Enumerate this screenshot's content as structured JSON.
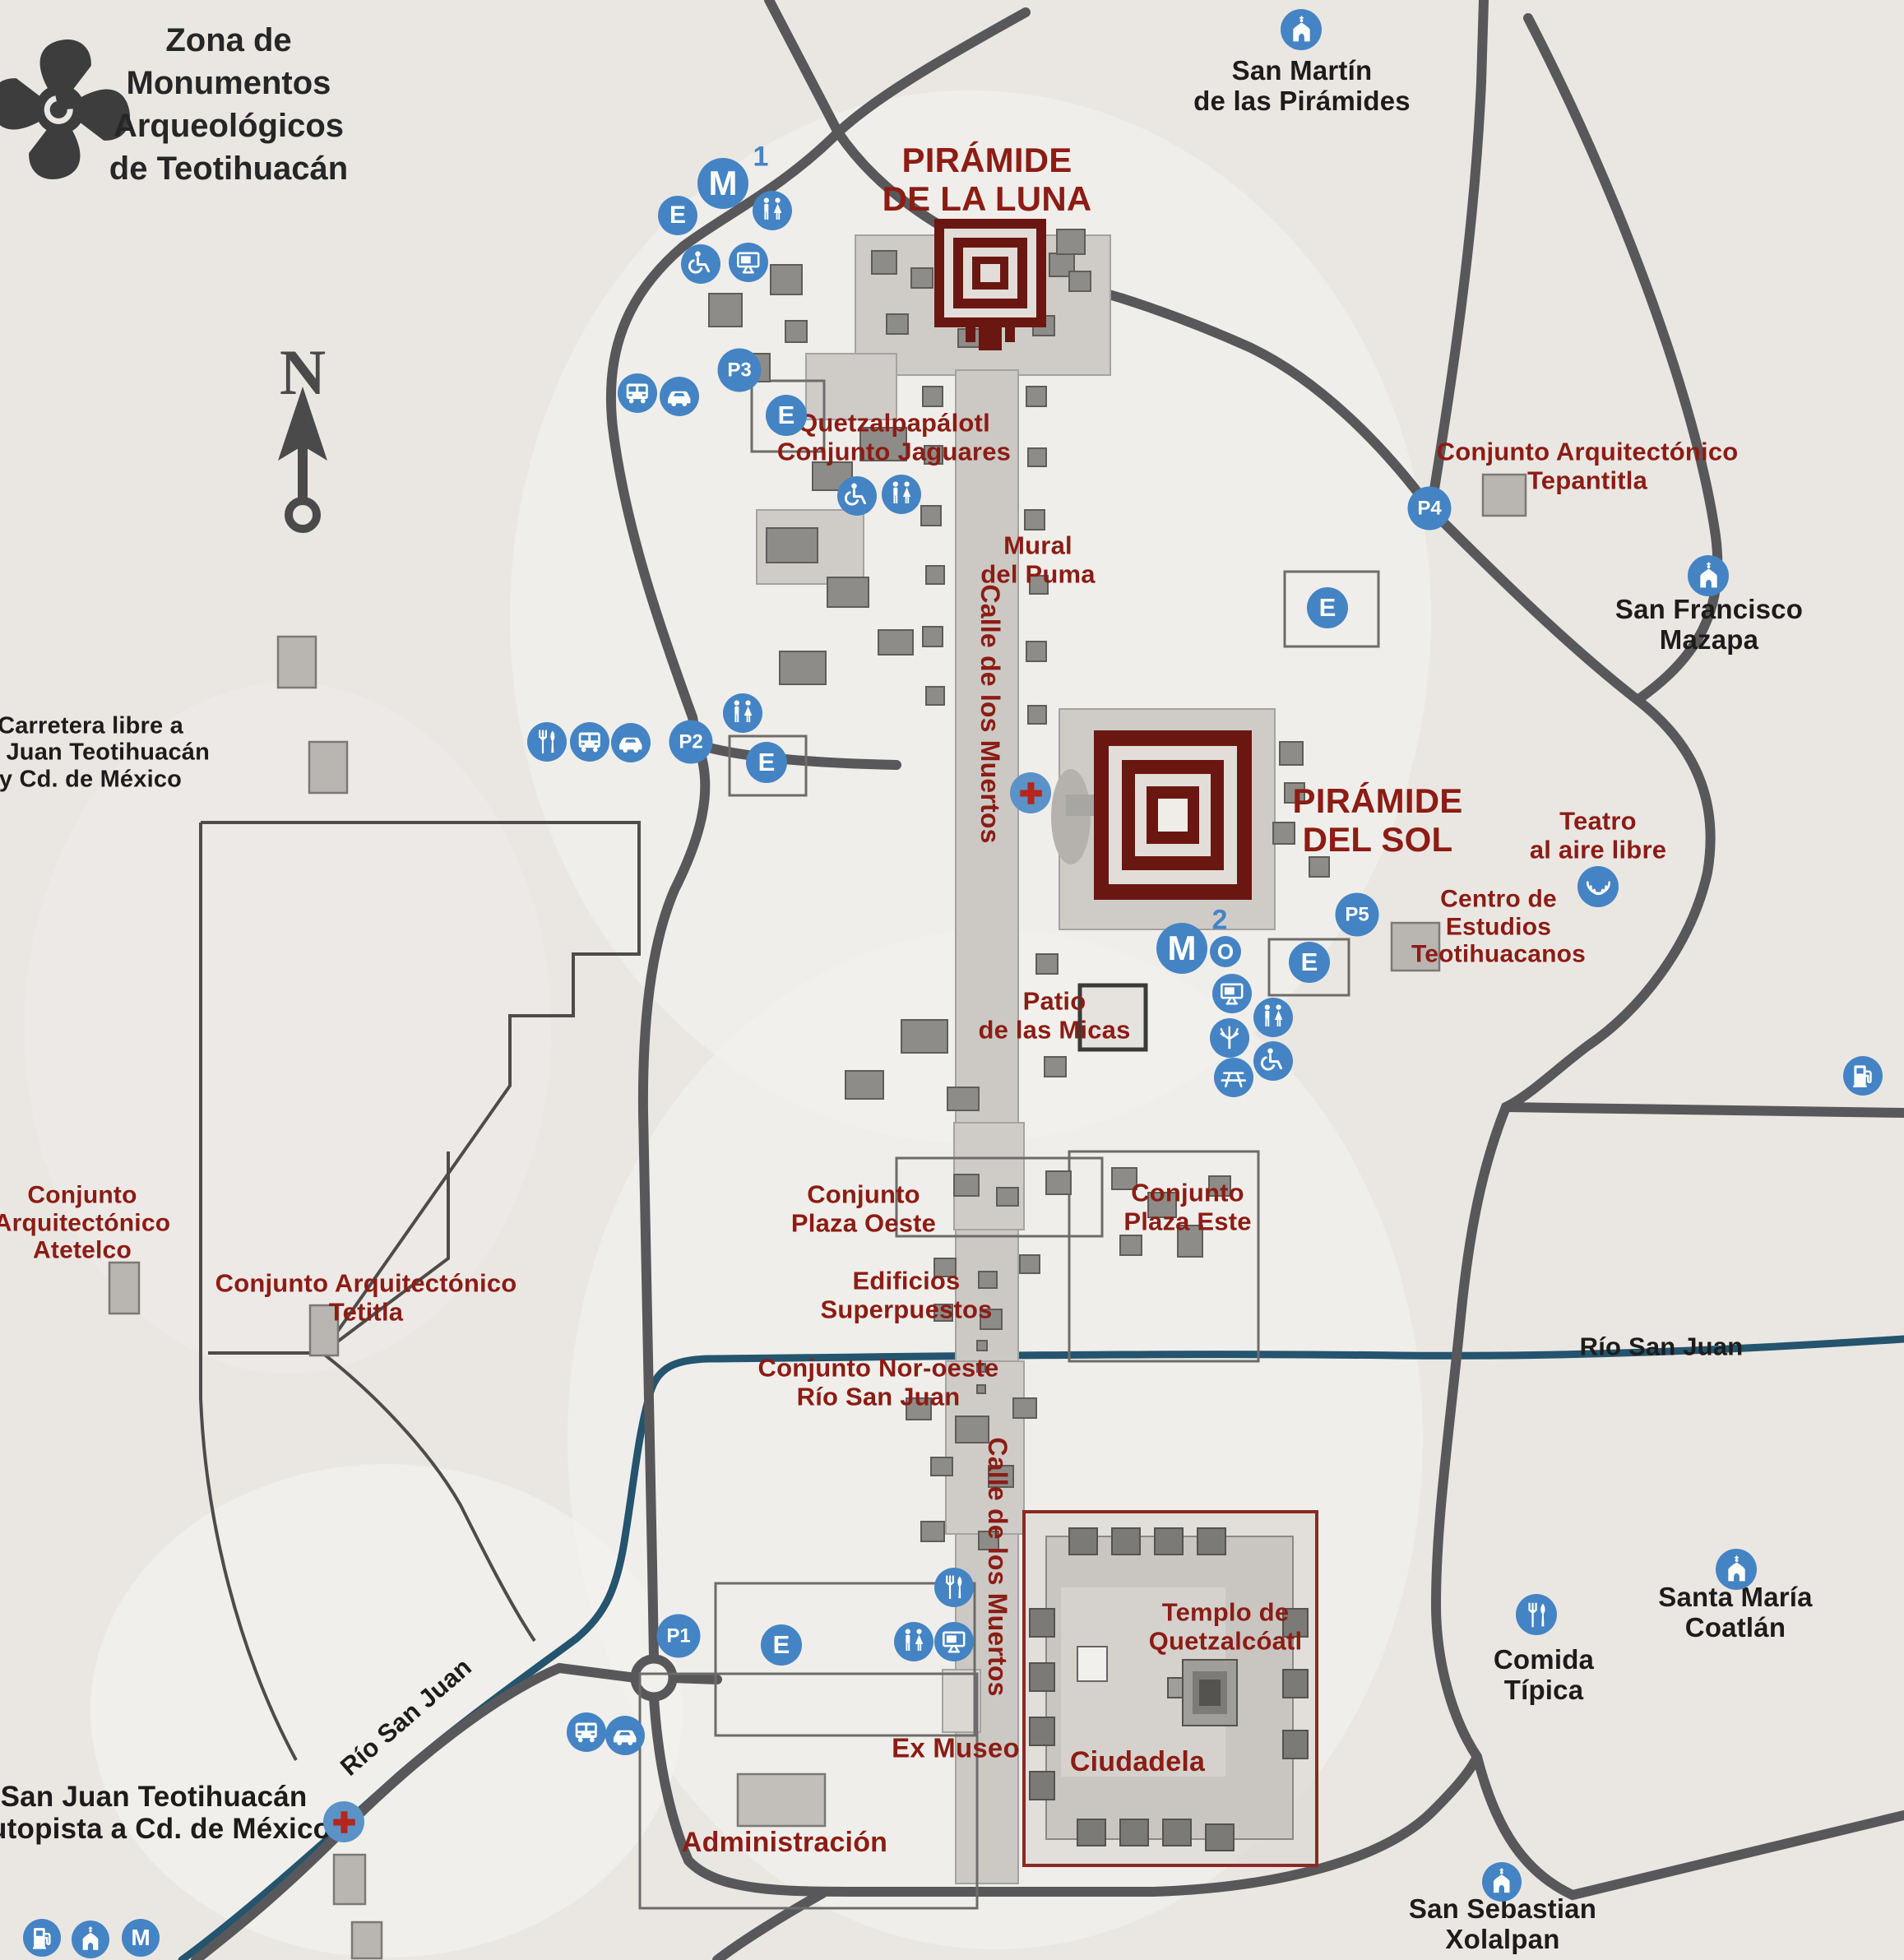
{
  "header": {
    "logo": "teotihuacan-glyph",
    "title": "Zona de\nMonumentos\nArqueológicos\nde Teotihuacán"
  },
  "compass": {
    "north": "N"
  },
  "colors": {
    "pin_blue": "#4484c4",
    "label_red": "#8c1c14",
    "pyramid_maroon": "#6b1711",
    "road_gray": "#58585a",
    "river_blue": "#24546e",
    "background": "#eae7e3"
  },
  "icons": {
    "parking_letter": "E",
    "museum_letter": "M",
    "museum_1_sup": "1",
    "museum_2_sup": "2",
    "lookout_letter": "O",
    "monument_letter": "M",
    "pictograms": [
      "restroom-icon",
      "wheelchair-icon",
      "bus-icon",
      "taxi-icon",
      "restaurant-icon",
      "first-aid-icon",
      "church-icon",
      "gas-station-icon",
      "theater-icon",
      "tree-icon",
      "picnic-table-icon",
      "audiovisual-icon"
    ]
  },
  "parking_markers": {
    "p1": "P1",
    "p2": "P2",
    "p3": "P3",
    "p4": "P4",
    "p5": "P5"
  },
  "sites": {
    "piramide_luna": "PIRÁMIDE\nDE LA LUNA",
    "piramide_sol": "PIRÁMIDE\nDEL SOL",
    "quetzalpapalotl": "Quetzalpapálotl\nConjunto Jaguares",
    "mural_puma": "Mural\ndel Puma",
    "patio_micas": "Patio\nde las Micas",
    "plaza_oeste": "Conjunto\nPlaza Oeste",
    "plaza_este": "Conjunto\nPlaza Este",
    "edificios": "Edificios\nSuperpuestos",
    "noroeste": "Conjunto Nor-oeste\nRío San Juan",
    "tepantitla": "Conjunto Arquitectónico\nTepantitla",
    "atetelco": "Conjunto\nArquitectónico\nAtetelco",
    "tetitla": "Conjunto Arquitectónico\nTetitla",
    "teatro": "Teatro\nal aire libre",
    "centro_estudios": "Centro de\nEstudios\nTeotihuacanos",
    "templo_q": "Templo de\nQuetzalcóatl",
    "ciudadela": "Ciudadela",
    "ex_museo": "Ex Museo",
    "administracion": "Administración",
    "calle_muertos": "Calle de los Muertos"
  },
  "towns": {
    "san_martin": "San Martín\nde las Pirámides",
    "sf_mazapa": "San Francisco\nMazapa",
    "sm_coatlan": "Santa María\nCoatlán",
    "ss_xolalpan": "San Sebastian\nXolalpan",
    "comida_tipica": "Comida\nTípica"
  },
  "routes": {
    "carretera_libre": "Carretera libre a\nan Juan Teotihuacán\ny Cd. de México",
    "a_san_juan": "A San Juan Teotihuacán\ny autopista a Cd. de México",
    "rio_san_juan": "Río San Juan"
  }
}
